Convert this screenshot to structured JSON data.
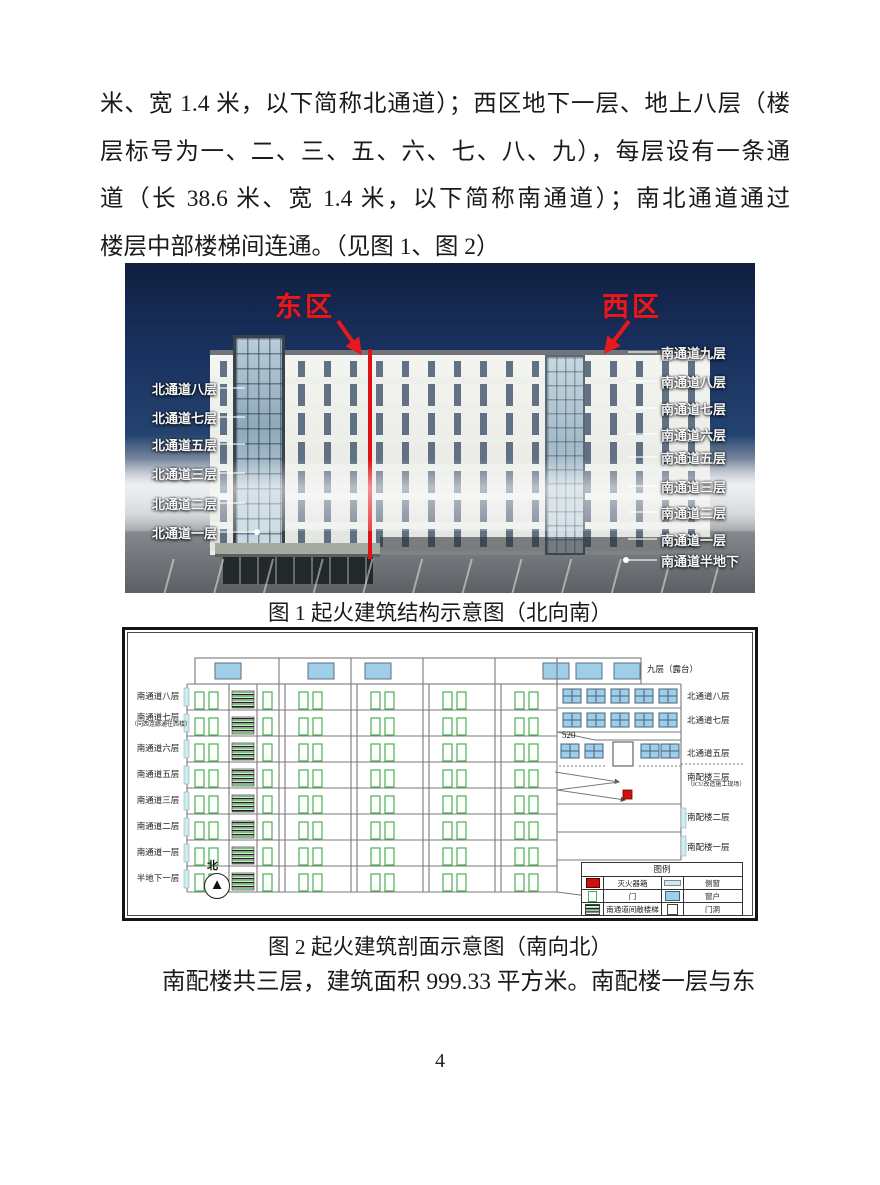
{
  "document": {
    "body_lines": [
      "米、宽 1.4 米，以下简称北通道）；西区地下一层、地上八层（楼",
      "层标号为一、二、三、五、六、七、八、九），每层设有一条通",
      "道（长 38.6 米、宽 1.4 米，以下简称南通道）；南北通道通过",
      "楼层中部楼梯间连通。（见图 1、图 2）"
    ],
    "closing_line": "南配楼共三层，建筑面积 999.33 平方米。南配楼一层与东",
    "page_number": "4"
  },
  "figure1": {
    "caption": "图 1 起火建筑结构示意图（北向南）",
    "zones": {
      "east": "东区",
      "west": "西区"
    },
    "left_labels": [
      "北通道八层",
      "北通道七层",
      "北通道五层",
      "北通道三层",
      "北通道二层",
      "北通道一层"
    ],
    "right_labels": [
      "南通道九层",
      "南通道八层",
      "南通道七层",
      "南通道六层",
      "南通道五层",
      "南通道三层",
      "南通道二层",
      "南通道一层",
      "南通道半地下"
    ],
    "colors": {
      "sky": "#1a3260",
      "divider_red": "#e01114",
      "zone_red": "#e8191c",
      "label_white": "#f7f9fb"
    }
  },
  "figure2": {
    "caption": "图 2 起火建筑剖面示意图（南向北）",
    "left_labels": [
      {
        "text": "南通道八层"
      },
      {
        "text": "南通道七层",
        "sub": "（向西连廊通往西楼）"
      },
      {
        "text": "南通道六层"
      },
      {
        "text": "南通道五层"
      },
      {
        "text": "南通道三层"
      },
      {
        "text": "南通道二层"
      },
      {
        "text": "南通道一层"
      },
      {
        "text": "半地下一层"
      }
    ],
    "right_labels": [
      {
        "text": "九层（露台）"
      },
      {
        "text": "北通道八层"
      },
      {
        "text": "北通道七层"
      },
      {
        "text": "北通道五层"
      },
      {
        "text": "南配楼三层",
        "sub": "（ICU改造施工现场）"
      },
      {
        "text": "南配楼二层"
      },
      {
        "text": "南配楼一层"
      }
    ],
    "annotation": "520",
    "compass": "北",
    "legend": {
      "title": "图例",
      "items": [
        {
          "icon": "extinguisher-box",
          "label": "灭火器箱"
        },
        {
          "icon": "side-window",
          "label": "侧窗"
        },
        {
          "icon": "door",
          "label": "门"
        },
        {
          "icon": "window",
          "label": "窗户"
        },
        {
          "icon": "open-staircase",
          "label": "南通道间敞楼梯"
        },
        {
          "icon": "door-opening",
          "label": "门洞"
        }
      ]
    },
    "colors": {
      "line_gray": "#7a7a7a",
      "door_green": "#4cae54",
      "window_blue": "#9fcfe8",
      "side_window_cyan": "#c8eef3",
      "marker_red": "#cc1111"
    }
  }
}
